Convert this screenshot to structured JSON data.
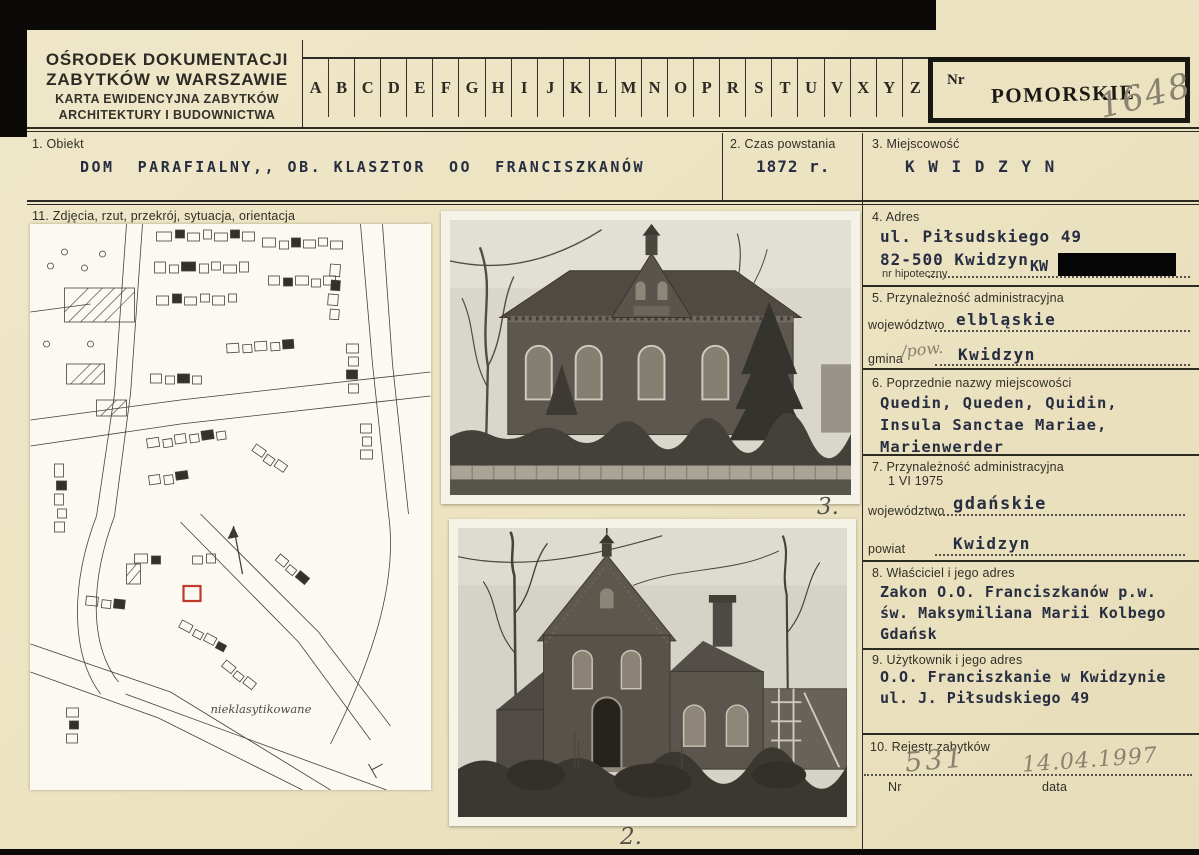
{
  "colors": {
    "card_background": "#ece3c2",
    "typed_ink": "#272e42",
    "handwriting_pencil": "#8a8270",
    "plot_highlight_red": "#bf3a2b"
  },
  "header": {
    "org_line1": "OŚRODEK DOKUMENTACJI",
    "org_line2": "ZABYTKÓW w WARSZAWIE",
    "card_line1": "KARTA EWIDENCYJNA ZABYTKÓW",
    "card_line2": "ARCHITEKTURY I BUDOWNICTWA",
    "alphabet": [
      "A",
      "B",
      "C",
      "D",
      "E",
      "F",
      "G",
      "H",
      "I",
      "J",
      "K",
      "L",
      "M",
      "N",
      "O",
      "P",
      "R",
      "S",
      "T",
      "U",
      "V",
      "X",
      "Y",
      "Z"
    ],
    "nr_label": "Nr",
    "voivodeship_stamp": "POMORSKIE",
    "nr_value": "1648"
  },
  "fields": {
    "f1": {
      "label": "1. Obiekt",
      "value": "DOM  PARAFIALNY,, OB. KLASZTOR  OO  FRANCISZKANÓW"
    },
    "f2": {
      "label": "2. Czas powstania",
      "value": "1872 r."
    },
    "f3": {
      "label": "3. Miejscowość",
      "value": "K W I D Z Y N"
    },
    "f4": {
      "label": "4. Adres",
      "line1": "ul. Piłsudskiego 49",
      "line2": "82-500 Kwidzyn",
      "sub_label": "nr hipoteczny",
      "sub_value": "KW"
    },
    "f5": {
      "label": "5. Przynależność administracyjna",
      "row1_label": "województwo",
      "row1_value": "elbląskie",
      "row2_label": "gmina",
      "row2_hand": "/pow.",
      "row2_value": "Kwidzyn"
    },
    "f6": {
      "label": "6. Poprzednie nazwy miejscowości",
      "lines": [
        "Quedin, Queden, Quidin,",
        "Insula Sanctae Mariae,",
        "Marienwerder"
      ]
    },
    "f7": {
      "label": "7. Przynależność administracyjna",
      "label2": "1 VI 1975",
      "row1_label": "województwo",
      "row1_value": "gdańskie",
      "row2_label": "powiat",
      "row2_value": "Kwidzyn"
    },
    "f8": {
      "label": "8. Właściciel i jego adres",
      "lines": [
        "Zakon O.O. Franciszkanów p.w.",
        "św. Maksymiliana Marii Kolbego",
        "Gdańsk"
      ]
    },
    "f9": {
      "label": "9. Użytkownik i jego adres",
      "lines": [
        "O.O. Franciszkanie w Kwidzynie",
        "ul. J. Piłsudskiego 49"
      ]
    },
    "f10": {
      "label": "10. Rejestr zabytków",
      "nr_label": "Nr",
      "nr_value": "531",
      "date_label": "data",
      "date_value": "14.04.1997"
    }
  },
  "media": {
    "section_label": "11. Zdjęcia, rzut, przekrój, sytuacja, orientacja",
    "map_note": "nieklasytikowane",
    "photo1_caption": "3.",
    "photo2_caption": "2."
  }
}
